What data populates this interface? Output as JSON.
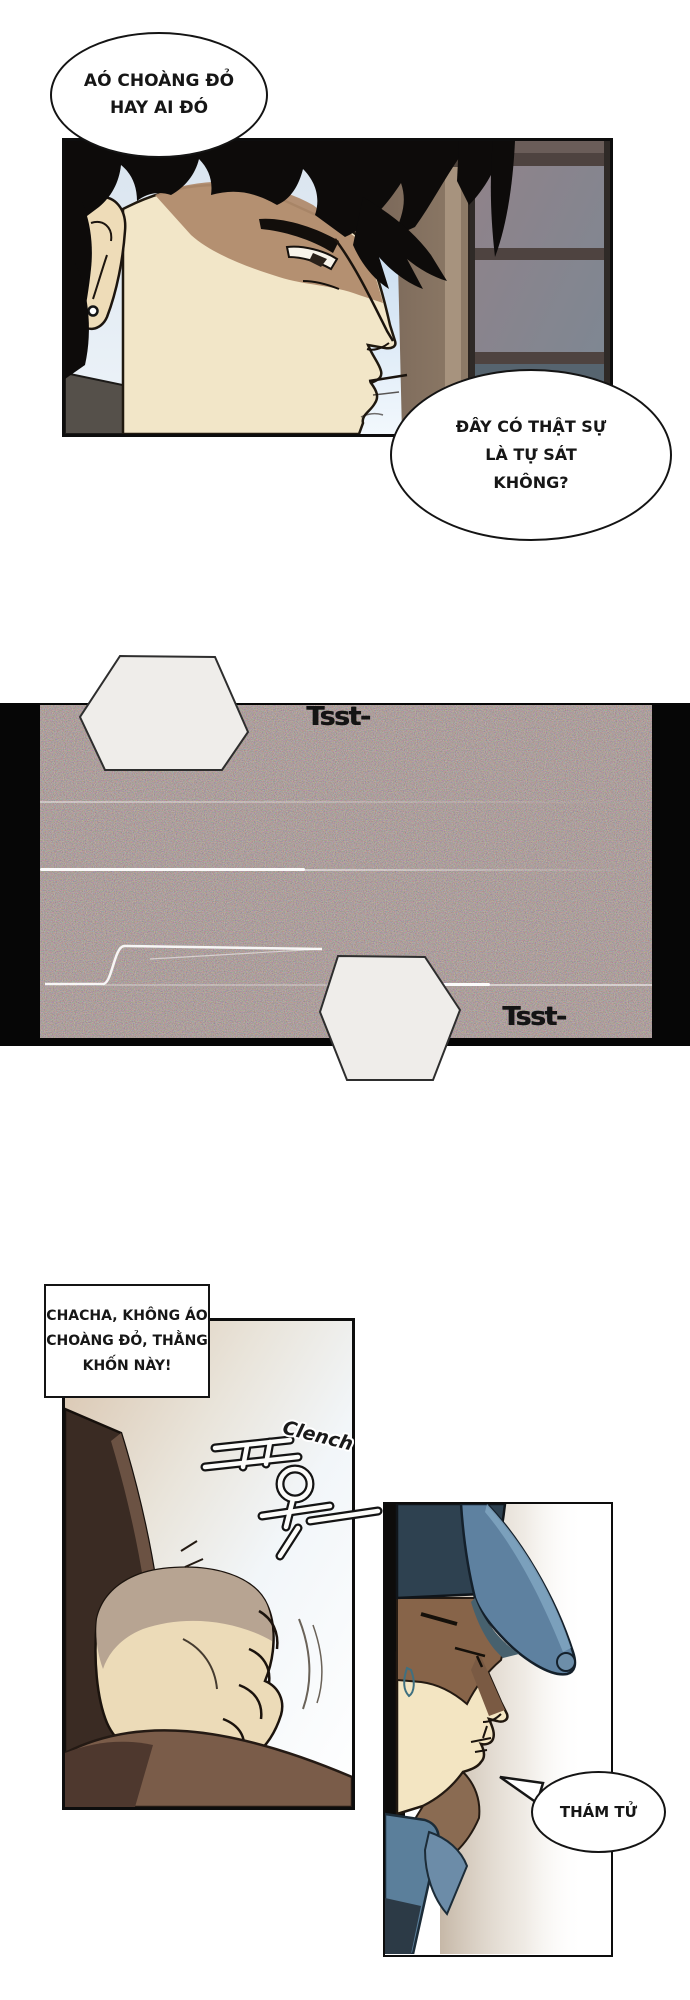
{
  "page": {
    "width": 690,
    "height": 2000,
    "background": "#ffffff",
    "ink": "#141414"
  },
  "palette": {
    "noise_base": "#46403b",
    "skin": "#f2e6c8",
    "skin_shadow": "#b08b6d",
    "hair_black": "#0d0b0a",
    "wardrobe_brown": "#7d6a5d",
    "shelf_grey": "#8b7d82",
    "window_blue": "#cfe2f4",
    "cap_navy": "#2e4150",
    "cap_brim_blue": "#5e81a0",
    "jacket_blue": "#5b7f9b",
    "sleeve_brown": "#3a2b23",
    "arm_brown": "#7a5c49",
    "fist_skin": "#ecdbb8",
    "fist_shade": "#b7a492"
  },
  "bubbles": {
    "top_thought": {
      "shape": "ellipse",
      "lines": [
        "AÓ CHOÀNG ĐỎ",
        "HAY AI ĐÓ"
      ]
    },
    "suicide_question": {
      "shape": "ellipse",
      "lines": [
        "ĐÂY CÓ THẬT SỰ",
        "LÀ TỰ SÁT",
        "KHÔNG?"
      ]
    },
    "detective": {
      "shape": "ellipse",
      "lines": [
        "THÁM TỬ"
      ]
    }
  },
  "caption_box": {
    "lines": [
      "CHACHA, KHÔNG ÁO",
      "CHOÀNG ĐỎ, THẰNG",
      "KHỐN NÀY!"
    ]
  },
  "sfx": {
    "tsst_top": {
      "shape": "hexagon",
      "text": "Tsst-"
    },
    "tsst_bottom": {
      "shape": "hexagon",
      "text": "Tsst-"
    },
    "clench": {
      "text": "Clench",
      "korean": "꾸욱"
    }
  },
  "panels": [
    {
      "id": "panel-man-profile",
      "description": "black-haired man in profile facing right before wardrobe shelves"
    },
    {
      "id": "panel-static-noise",
      "description": "dark TV-static strip with white scratch lines"
    },
    {
      "id": "panel-clenched-fist",
      "description": "clenched fist with dark sleeve and shoulder"
    },
    {
      "id": "panel-cap-man",
      "description": "man in blue cap in profile with sweat drop"
    }
  ]
}
